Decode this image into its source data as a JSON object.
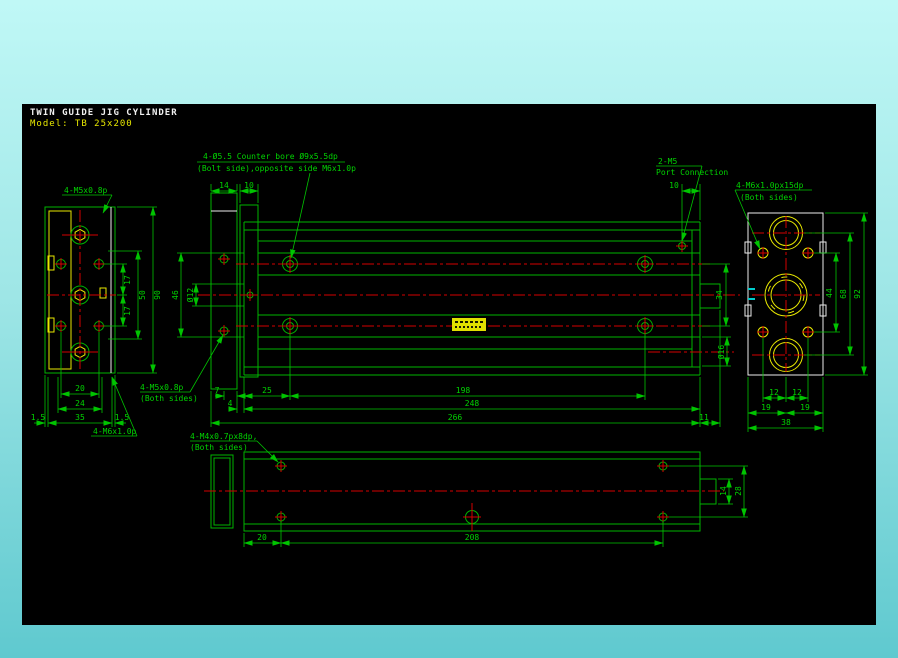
{
  "title": {
    "line1": "TWIN GUIDE JIG CYLINDER",
    "line2": "Model: TB 25x200"
  },
  "annotations": {
    "counterbore": {
      "l1": "4-Ø5.5 Counter bore Ø9x5.5dp",
      "l2": "(Bolt side),opposite side M6x1.0p"
    },
    "port": {
      "l1": "2-M5",
      "l2": "Port Connection"
    },
    "right_thread": {
      "l1": "4-M6x1.0px15dp",
      "l2": "(Both sides)"
    },
    "left_top_thread": {
      "l1": "4-M5x0.8p"
    },
    "left_bottom_thread": {
      "l1": "4-M6x1.0p"
    },
    "mid_thread": {
      "l1": "4-M5x0.8p",
      "l2": "(Both sides)"
    },
    "bottom_thread": {
      "l1": "4-M4x0.7px8dp,",
      "l2": "(Both sides)"
    }
  },
  "dims": {
    "front": {
      "w14": "14",
      "w10": "10",
      "port10": "10",
      "h46": "46",
      "rod12": "Ø12",
      "s34": "34",
      "rod16": "Ø16",
      "b7": "7",
      "b25": "25",
      "b198": "198",
      "b4": "4",
      "b248": "248",
      "b266": "266",
      "b11": "11"
    },
    "left": {
      "t17a": "17",
      "t17b": "17",
      "t50": "50",
      "t90": "90",
      "b20": "20",
      "b24": "24",
      "b35": "35",
      "m15l": "1.5",
      "m15r": "1.5"
    },
    "right": {
      "v44": "44",
      "v68": "68",
      "v92": "92",
      "b12l": "12",
      "b12r": "12",
      "b19l": "19",
      "b19r": "19",
      "b38": "38"
    },
    "bottom": {
      "b20": "20",
      "b208": "208",
      "r14": "14",
      "r28": "28"
    }
  },
  "colors": {
    "background_top": "#c0f8f6",
    "background_bottom": "#5fc9cf",
    "canvas": "#000000",
    "line_green": "#00b400",
    "text_green": "#00d400",
    "centerline_red": "#d40000",
    "detail_yellow": "#e8e800",
    "outline_white": "#ebebeb",
    "accent_cyan": "#00cccc",
    "title_white": "#f0f0f0",
    "title_yellow": "#e8e800"
  }
}
